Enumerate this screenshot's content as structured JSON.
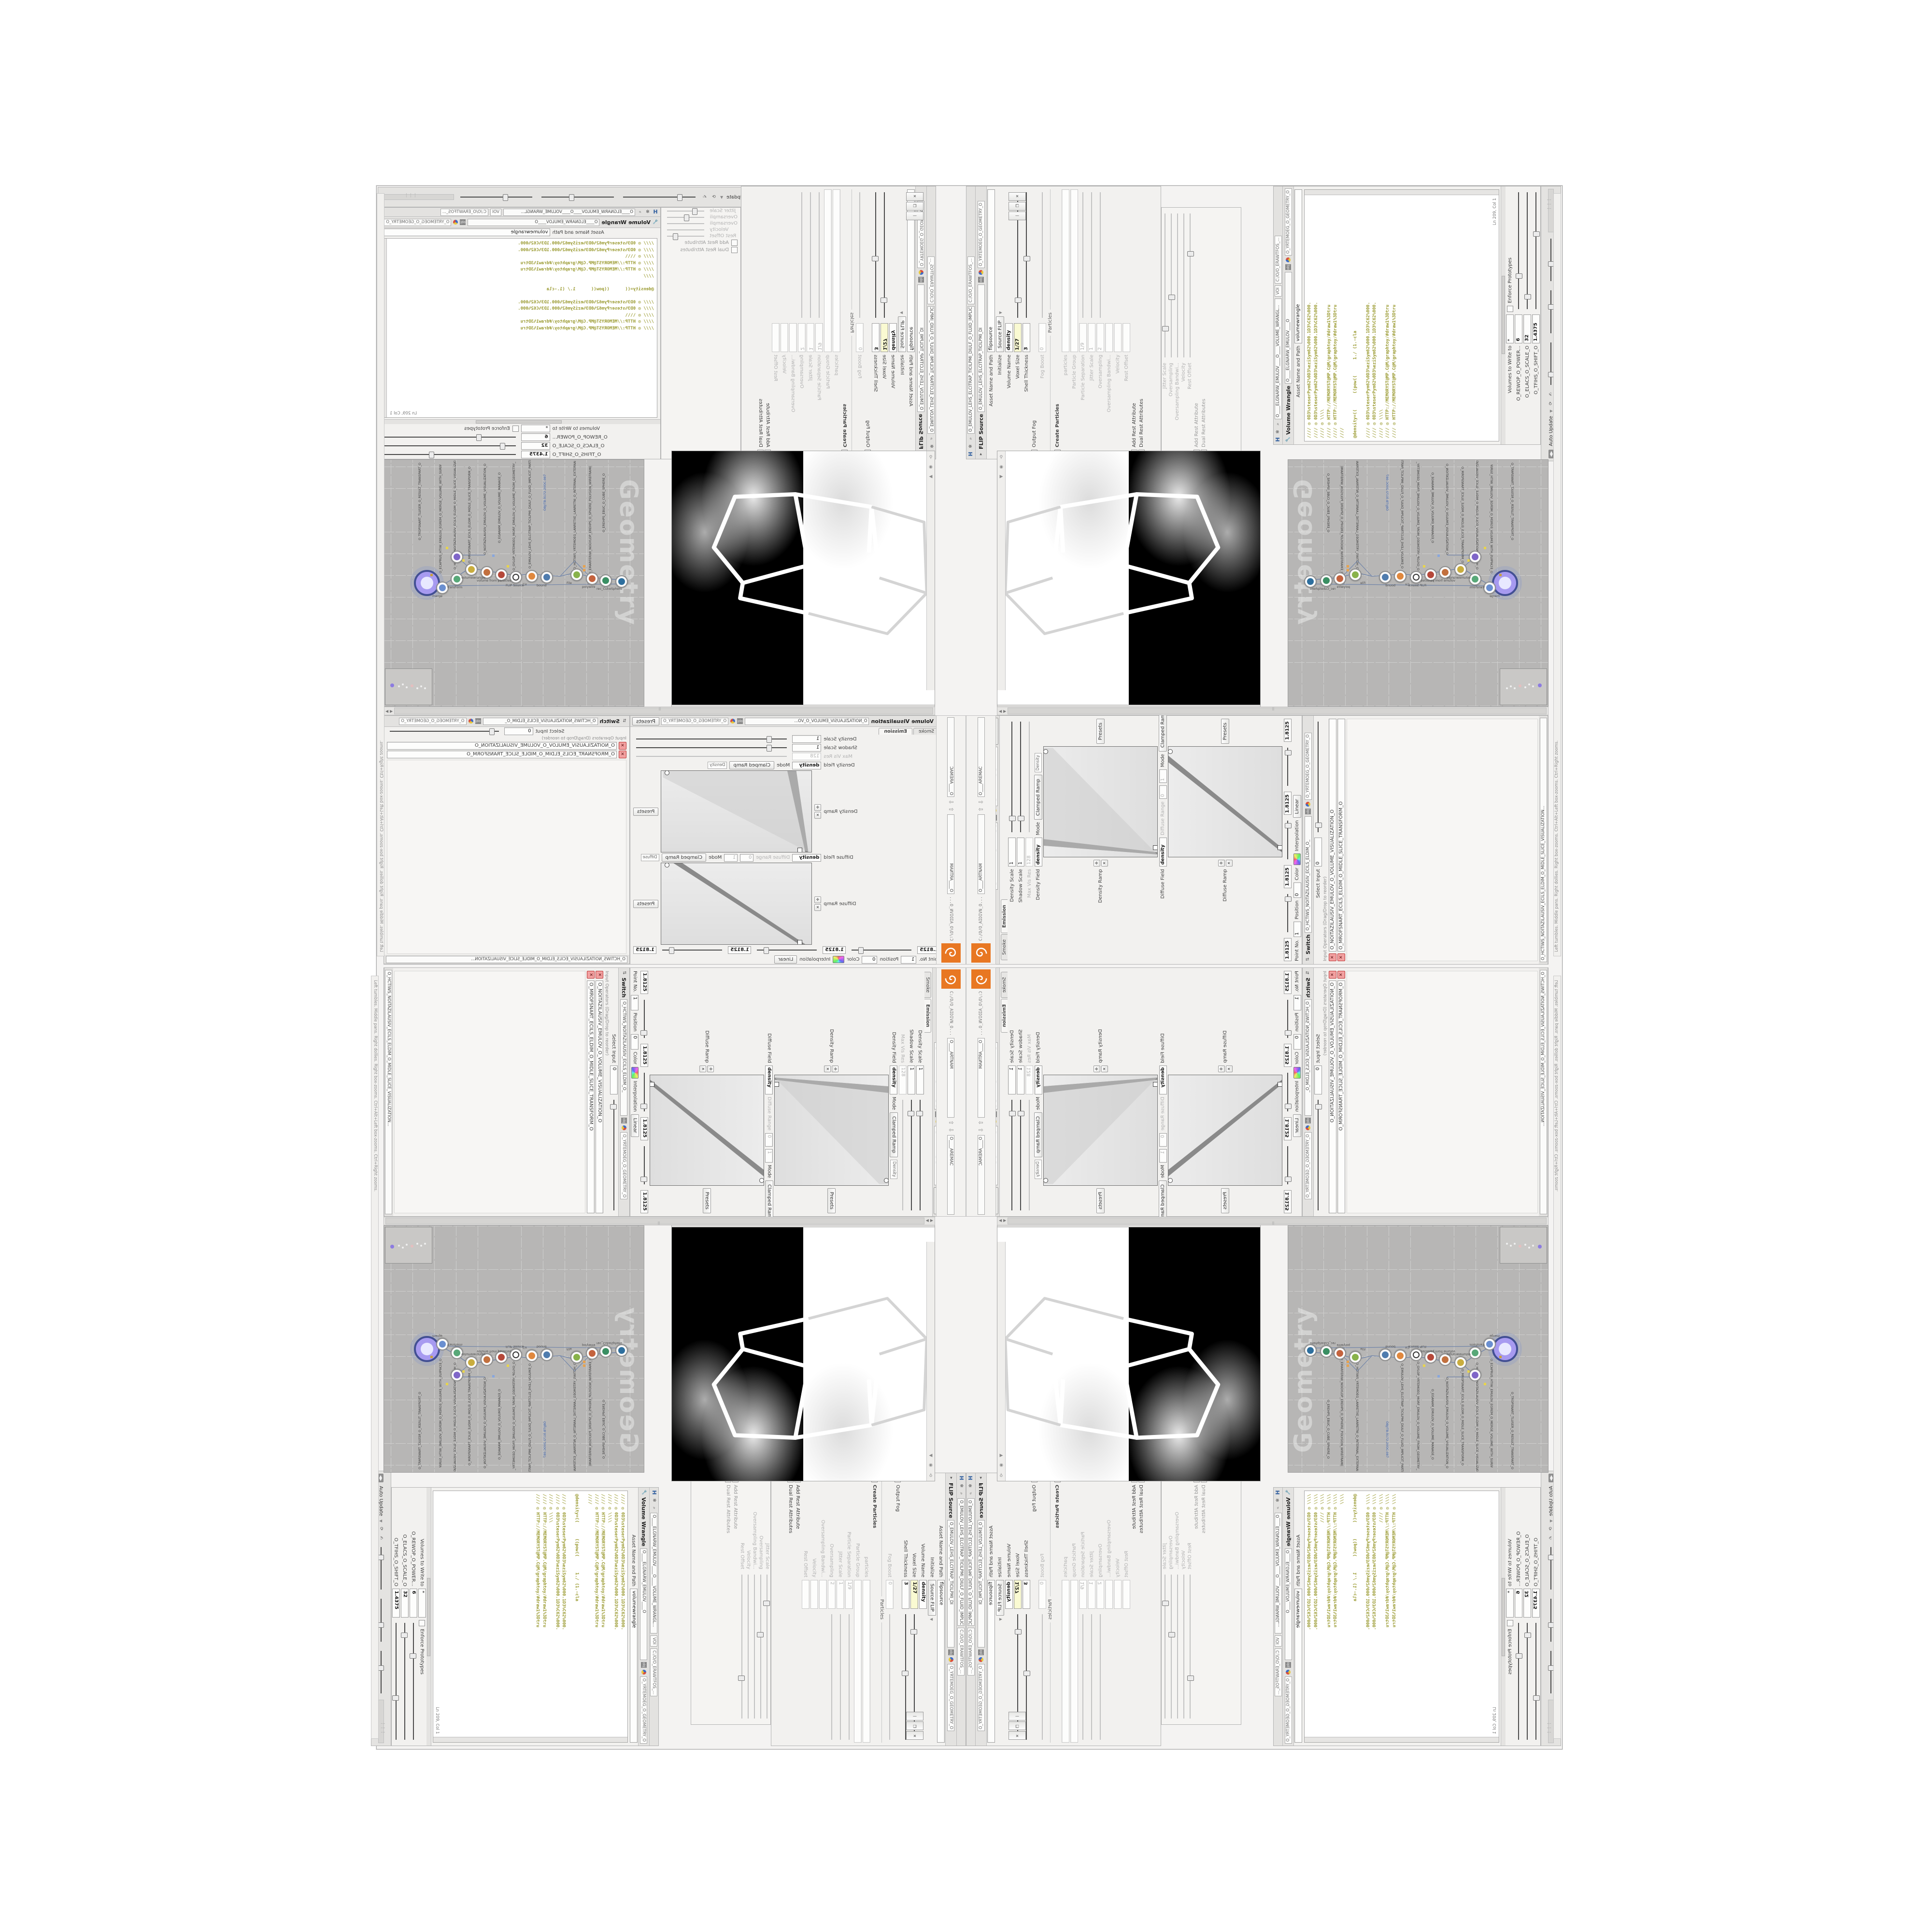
{
  "chrome": {
    "auto_update": "Auto Update",
    "status_hint": "Left tumbles. Middle pans. Right dollies. Right box-zooms. Ctrl+Alt+Left box-zooms. Ctrl+Right zooms.",
    "software_path": "C:/O/O_ERAWTFOS_...",
    "nvidia_path": "C:/O/O_AIDIVN_O...",
    "obj": "obj",
    "geometry_net": "O_YRTEMOEG_O_GEOMETRY_O",
    "mantra_tab": "O____ARTNAM",
    "camera_tab": "O____AREMAC",
    "voi_tab": "VOI",
    "ln_col": "Ln 209, Col 1"
  },
  "icons": {
    "close": "✕",
    "maximize": "❐",
    "minimize": "—",
    "left": "◀",
    "right": "▶",
    "up": "⇧",
    "down": "⇩",
    "gear": "✻",
    "search": "⌕",
    "help": "?",
    "info": "i",
    "pin": "⚲",
    "recycle": "⟳",
    "hand": "✍",
    "caret": "▾",
    "h_logo": "H",
    "pot": "◍",
    "brush": "✑",
    "divider": "▏",
    "magnet": "∩",
    "grid": "▦",
    "tri": "❋",
    "flower": "✽",
    "axes": "✥",
    "rot": "↻",
    "target": "◉",
    "plus": "✛"
  },
  "wrangle": {
    "title": "Volume Wrangle",
    "path": "O____ELGNARW_EMULOV____O____VOLUME_WRANGL...",
    "path_tab": "O____ELGNARW_EMULOV____O",
    "asset_label": "Asset Name and Path",
    "asset_value": "volumewrangle",
    "code_lines": [
      "//// ◎ 0D3%steserPym62%0D3%eziSym62%000.1D3%C62%000.",
      "//// ◎ 0D3%steserPym62%0D3%eziSym62%000.1D3%C62%000.",
      "//// ◎ \\\\\\\\",
      "//// ◎ HTTP://MEMORYST@MP.C@M/graphtoy/#draw1%3Dtru",
      "//// ◎ HTTP://MEMORYST@MP.C@M/graphtoy/#draw1%3Dtru",
      "////",
      "",
      "@density=((      ((pow((      1./ (1.-cla",
      "",
      "//// ◎ 0D3%steserPym62%0D3%eziSym62%000.1D3%C62%000.",
      "//// ◎ 0D3%steserPym62%0D3%eziSym62%000.1D3%C62%000.",
      "//// ◎ \\\\\\\\",
      "//// ◎ HTTP://MEMORYST@MP.C@M/graphtoy/#draw1%3Dtru",
      "//// ◎ HTTP://MEMORYST@MP.C@M/graphtoy/#draw1%3Dtru"
    ],
    "volumes_label": "Volumes to Write to",
    "volumes_value": "*",
    "enforce_label": "Enforce Prototypes",
    "params": [
      {
        "label": "O_REWOP_O_POWER...",
        "value": "6"
      },
      {
        "label": "O_ELACS_O_SCALE_O",
        "value": "32"
      },
      {
        "label": "O_TFIHS_O_SHIFT_O",
        "value": "1.4375"
      }
    ]
  },
  "flip": {
    "title": "FLIP Source",
    "path": "O_EMULOV_LEHS_ELCITRAP_TICILPMI_DIULF_O_FLUID_IMPLICIT_PARTICLE...",
    "path_tab": "O_EMULOV_LEHS_ELCITRAP_TICILPMI_DI",
    "asset_label": "Asset Name and Path",
    "asset_value": "flipsource",
    "initialize_label": "Initialize",
    "source_btn": "Source FLIP",
    "particles_section": "Particles",
    "rows": [
      {
        "label": "Volume Name",
        "value": "density"
      },
      {
        "label": "Voxel Size",
        "value": "1/27"
      },
      {
        "label": "Shell Thickness",
        "value": "3"
      },
      {
        "label": "Output Fog",
        "value": ""
      },
      {
        "label": "Fog Boost",
        "value": "0"
      },
      {
        "label": "Create Particles",
        "value": ""
      },
      {
        "label": "particles",
        "value": ""
      },
      {
        "label": "Particle Group",
        "value": ""
      },
      {
        "label": "Particle Separation",
        "value": "1/9"
      },
      {
        "label": "Jitter Scale",
        "value": "1"
      },
      {
        "label": "Oversampling",
        "value": "2"
      },
      {
        "label": "Oversampling Bandwi...",
        "value": ""
      },
      {
        "label": "Velocity",
        "value": ""
      },
      {
        "label": "Rest Offset",
        "value": ""
      },
      {
        "label": "Add Rest Attribute",
        "value": ""
      },
      {
        "label": "Dual Rest Attributes",
        "value": ""
      }
    ]
  },
  "viz": {
    "title": "Volume Visualization",
    "path": "O_NOITAZILAUSIV_EMULOV_O_VO...",
    "path_tab": "O_NOITAZILAUSIV_ECILS_ELDIM_O_",
    "presets": "Presets",
    "tab_smoke": "Smoke",
    "tab_emission": "Emission",
    "rows": {
      "density_scale": "Density Scale",
      "density_scale_v": "1",
      "shadow_scale": "Shadow Scale",
      "shadow_scale_v": "1",
      "max_vis_res": "Max Vis Res",
      "max_vis_res_v": "128",
      "density_field": "Density Field",
      "density_field_v": "density",
      "mode": "Mode",
      "mode_v": "Clamped Ramp",
      "density_chip": "Density",
      "diffuse_chip": "Diffuse",
      "density_ramp": "Density Ramp",
      "diffuse_field": "Diffuse Field",
      "diffuse_field_v": "density",
      "diffuse_range": "Diffuse Range",
      "diffuse_range_v0": "0",
      "diffuse_range_v1": "1",
      "diffuse_ramp": "Diffuse Ramp",
      "point_no": "Point No.",
      "point_no_v": "1",
      "position": "Position",
      "position_v": "0",
      "color": "Color",
      "interpolation": "Interpolation",
      "interpolation_v": "Linear",
      "ramp_value": "1.8125"
    }
  },
  "switch": {
    "title": "Switch",
    "path": "O_HCTIWS_NOITAZILAUSIV_ECILS_ELDIM_O_MIDLE_SLICE_VISUALIZATION...",
    "path_tab": "O_HCTIWS_NOITAZILAUSIV_ECILS_ELDIM_O_",
    "select_label": "Select Input",
    "select_value": "0",
    "list_caption": "Input Operators (Drag/Drop to reorder)",
    "items": [
      "O_NOITAZILAUSIV_EMULOV_O_VOLUME_VISUALIZATION_O",
      "O_MROFSNART_ECILS_ELDIM_O_MIDLE_SLICE_TRANSFORM_O"
    ]
  },
  "net": {
    "watermark": "Geometry",
    "node_labels": [
      "O_TROPSNART_TLUSER_O_RESULT_TRANSPART_O",
      "O_ECAPRUS_HTIW_EMULOV_EGREM_O_MERGE_VOLUME_WITH_SURFACE_O",
      "O_HCTIWS_NOITAZILAUSIV_ECILS_ELDIM_O_MIDLE_SLICE_VISUALIZATION_SWITCH_O",
      "O_MROPSNART_ECILS_ELDIM_O_MIDLE_SLICE_TRANSPORM_O",
      "O_NOITAZILAUSIV_EMULOV_O_VOLUME_VISUALIZATION_O",
      "O_EGANAM_EMULOV_O_VOLUME_MANAGE_O",
      "O_GYLOP_YRTEMOEG_MORF_EMULOV_O_VOLUME_FROM_GEOMETRY_POLYG_O",
      "O_EMULOV_LEHS_ELCITRAP_TICILPMI_DIULF_O_FLUID_IMPLICIT_PARTICLE_SHEL_VOLUME_O",
      "OBJ/TB.9172.2VOC.087",
      "O_HCTIWS_YRTEMOEG_LANRETXE_LANRETNI_O_INTERNAL_EXTERNAL_GEOMETRY_SWITCH_O",
      "O_EMARFERIW_NOGYLOP_EREHPS_O_SPHERE_POLYGON_WIREFRAME_O",
      "O_EREHPS_EBUC_O_CUBE_SPHERE_O"
    ],
    "node_sublabels": [
      "merge",
      "Transform",
      "volumewrangle",
      "volume from particles",
      "FLIP Source",
      "Cir",
      "bound",
      "File",
      "polywire",
      "rec_CubeSphere"
    ]
  }
}
